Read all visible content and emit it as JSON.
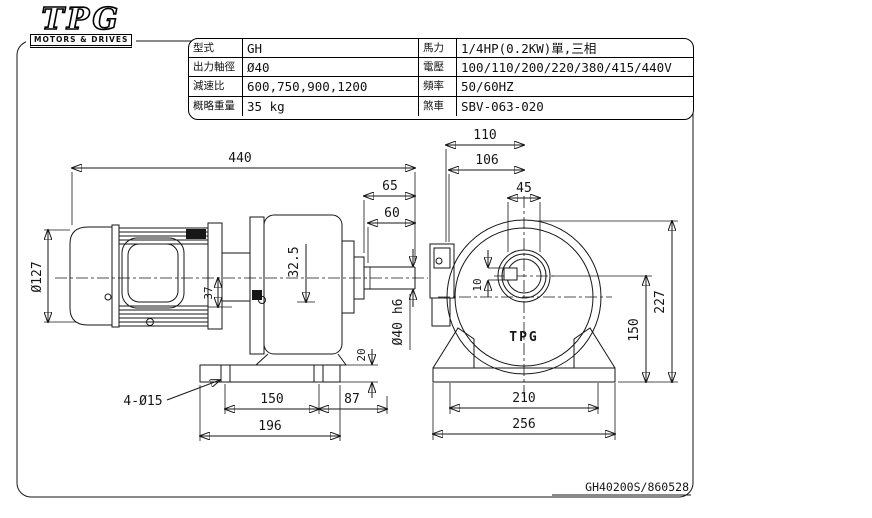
{
  "logo": {
    "brand": "TPG",
    "tagline": "MOTORS & DRIVES"
  },
  "spec_table": {
    "rows": [
      {
        "label_left": "型式",
        "value_left": "GH",
        "label_right": "馬力",
        "value_right": "1/4HP(0.2KW)單,三相"
      },
      {
        "label_left": "出力軸徑",
        "value_left": "Ø40",
        "label_right": "電壓",
        "value_right": "100/110/200/220/380/415/440V"
      },
      {
        "label_left": "減速比",
        "value_left": "600,750,900,1200",
        "label_right": "頻率",
        "value_right": "50/60HZ"
      },
      {
        "label_left": "概略重量",
        "value_left": "35 kg",
        "label_right": "煞車",
        "value_right": "SBV-063-020"
      }
    ]
  },
  "side_view": {
    "dims": {
      "overall_length": "440",
      "housing_to_shaft_end": "65",
      "shaft_length": "60",
      "motor_diameter": "Ø127",
      "center_offset": "37",
      "housing_offset": "32.5",
      "shaft_diameter": "Ø40 h6",
      "base_thickness": "20",
      "mounting_holes": "4-Ø15",
      "hole_spacing": "150",
      "hole_to_face": "87",
      "base_length": "196"
    }
  },
  "front_view": {
    "case_logo": "TPG",
    "dims": {
      "box_to_center": "110",
      "box_to_center_inner": "106",
      "boss_width": "45",
      "keyway": "10",
      "overall_height": "227",
      "center_height": "150",
      "foot_hole_spacing": "210",
      "base_width": "256"
    }
  },
  "drawing_number": "GH40200S/860528"
}
